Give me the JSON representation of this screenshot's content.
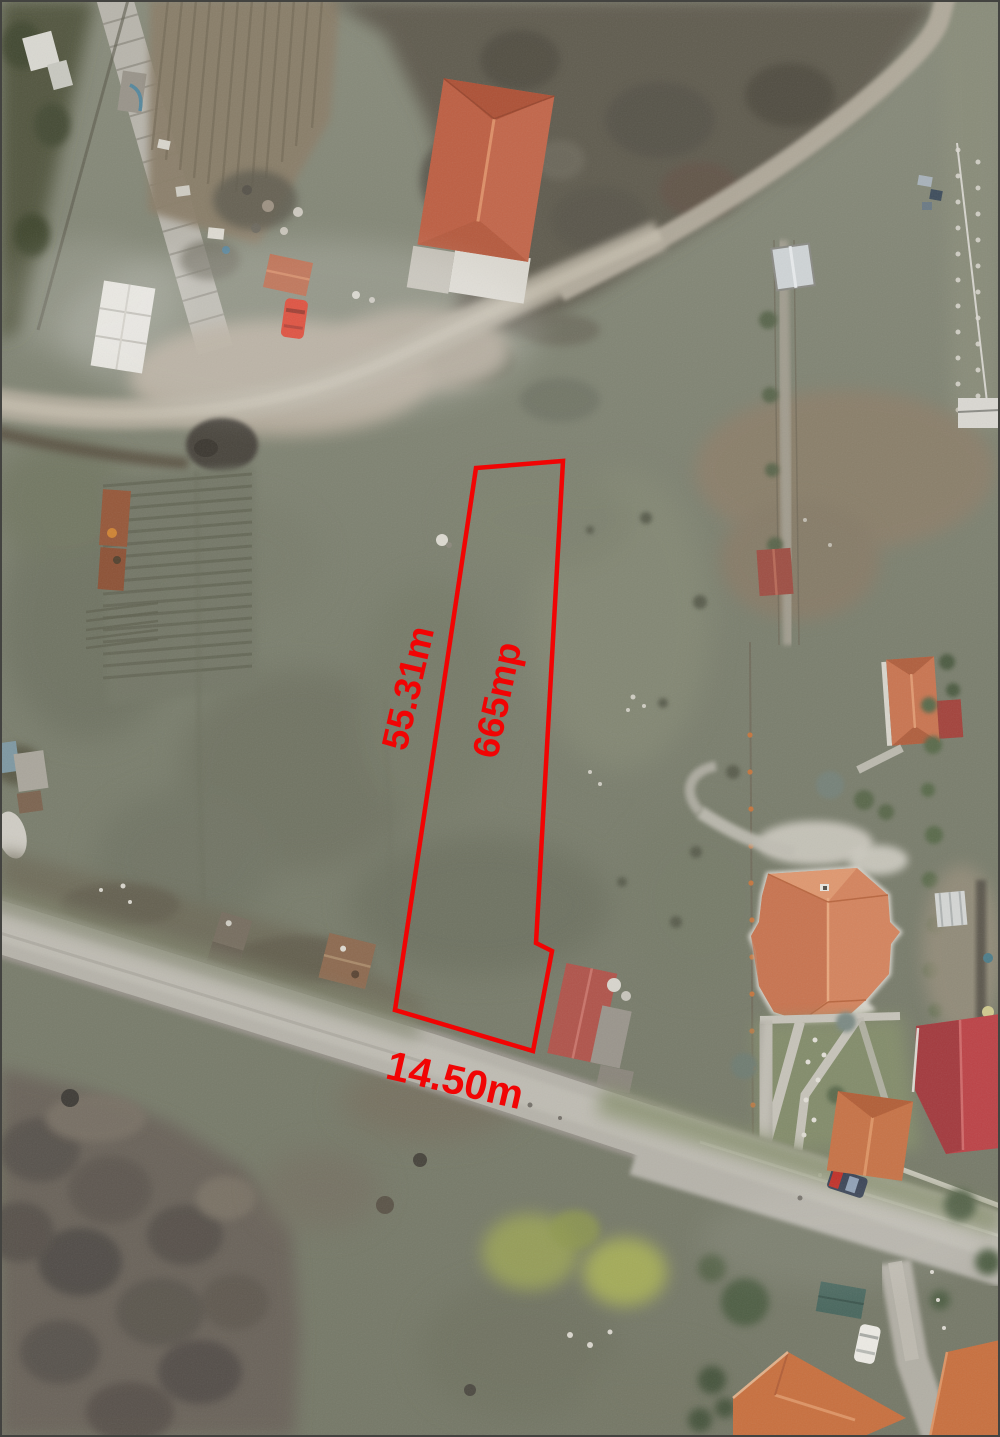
{
  "annotation": {
    "outline_color": "#f10404",
    "label_color": "#f10404",
    "labels": {
      "side_length": "55.31m",
      "area": "665mp",
      "street_frontage": "14.50m"
    }
  }
}
